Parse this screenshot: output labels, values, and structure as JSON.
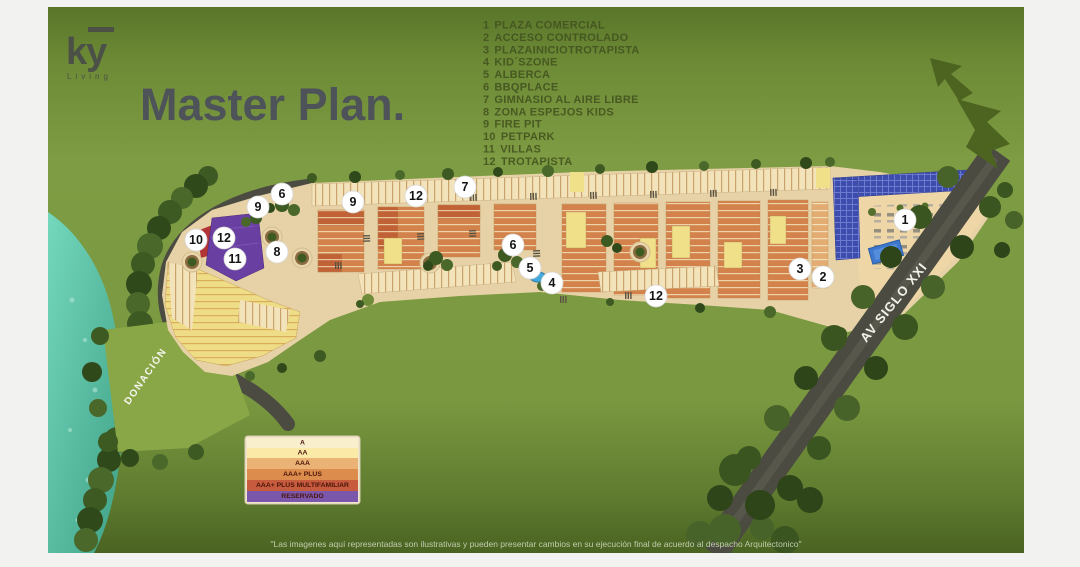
{
  "brand": {
    "logo_text": "ky",
    "logo_sub": "Living"
  },
  "title": "Master Plan.",
  "amenities": {
    "items": [
      {
        "num": "1",
        "label": "PLAZA COMERCIAL"
      },
      {
        "num": "2",
        "label": "ACCESO CONTROLADO"
      },
      {
        "num": "3",
        "label": "PLAZAINICIOTROTAPISTA"
      },
      {
        "num": "4",
        "label": "KID´SZONE"
      },
      {
        "num": "5",
        "label": "ALBERCA"
      },
      {
        "num": "6",
        "label": "BBQPLACE"
      },
      {
        "num": "7",
        "label": "GIMNASIO AL AIRE LIBRE"
      },
      {
        "num": "8",
        "label": "ZONA ESPEJOS KIDS"
      },
      {
        "num": "9",
        "label": "FIRE PIT"
      },
      {
        "num": "10",
        "label": "PETPARK"
      },
      {
        "num": "11",
        "label": "VILLAS"
      },
      {
        "num": "12",
        "label": "TROTAPISTA"
      }
    ]
  },
  "map": {
    "labels": {
      "donacion": "DONACIÓN",
      "avenue": "AV SIGLO XXI"
    },
    "markers": [
      {
        "label": "1"
      },
      {
        "label": "2"
      },
      {
        "label": "3"
      },
      {
        "label": "4"
      },
      {
        "label": "5"
      },
      {
        "label": "6"
      },
      {
        "label": "7"
      },
      {
        "label": "8"
      },
      {
        "label": "9"
      },
      {
        "label": "10"
      },
      {
        "label": "11"
      },
      {
        "label": "12"
      },
      {
        "label": "6"
      },
      {
        "label": "9"
      },
      {
        "label": "12"
      },
      {
        "label": "12"
      }
    ]
  },
  "legend": {
    "rows": [
      {
        "label": "A",
        "color": "#f9efcd"
      },
      {
        "label": "AA",
        "color": "#fbe9a8"
      },
      {
        "label": "AAA",
        "color": "#eab275"
      },
      {
        "label": "AAA+ PLUS",
        "color": "#dc8c4c"
      },
      {
        "label": "AAA+ PLUS MULTIFAMILIAR",
        "color": "#c75b3d"
      },
      {
        "label": "RESERVADO",
        "color": "#7a57ab"
      }
    ]
  },
  "disclaimer": "\"Las imagenes aquí representadas son ilustrativas y pueden presentar cambios en su ejecución final de acuerdo al despacho Arquitectonico\"",
  "colors": {
    "field_green": "#7d9b42",
    "title_text": "#4d5358",
    "amenities_text": "#42521f",
    "reserved_purple": "#6a3fa2",
    "multifamiliar_red": "#b23434",
    "commercial_blue": "#3e4dad",
    "river_teal": "#5ec9ab",
    "road_gray": "#4b4b41"
  }
}
